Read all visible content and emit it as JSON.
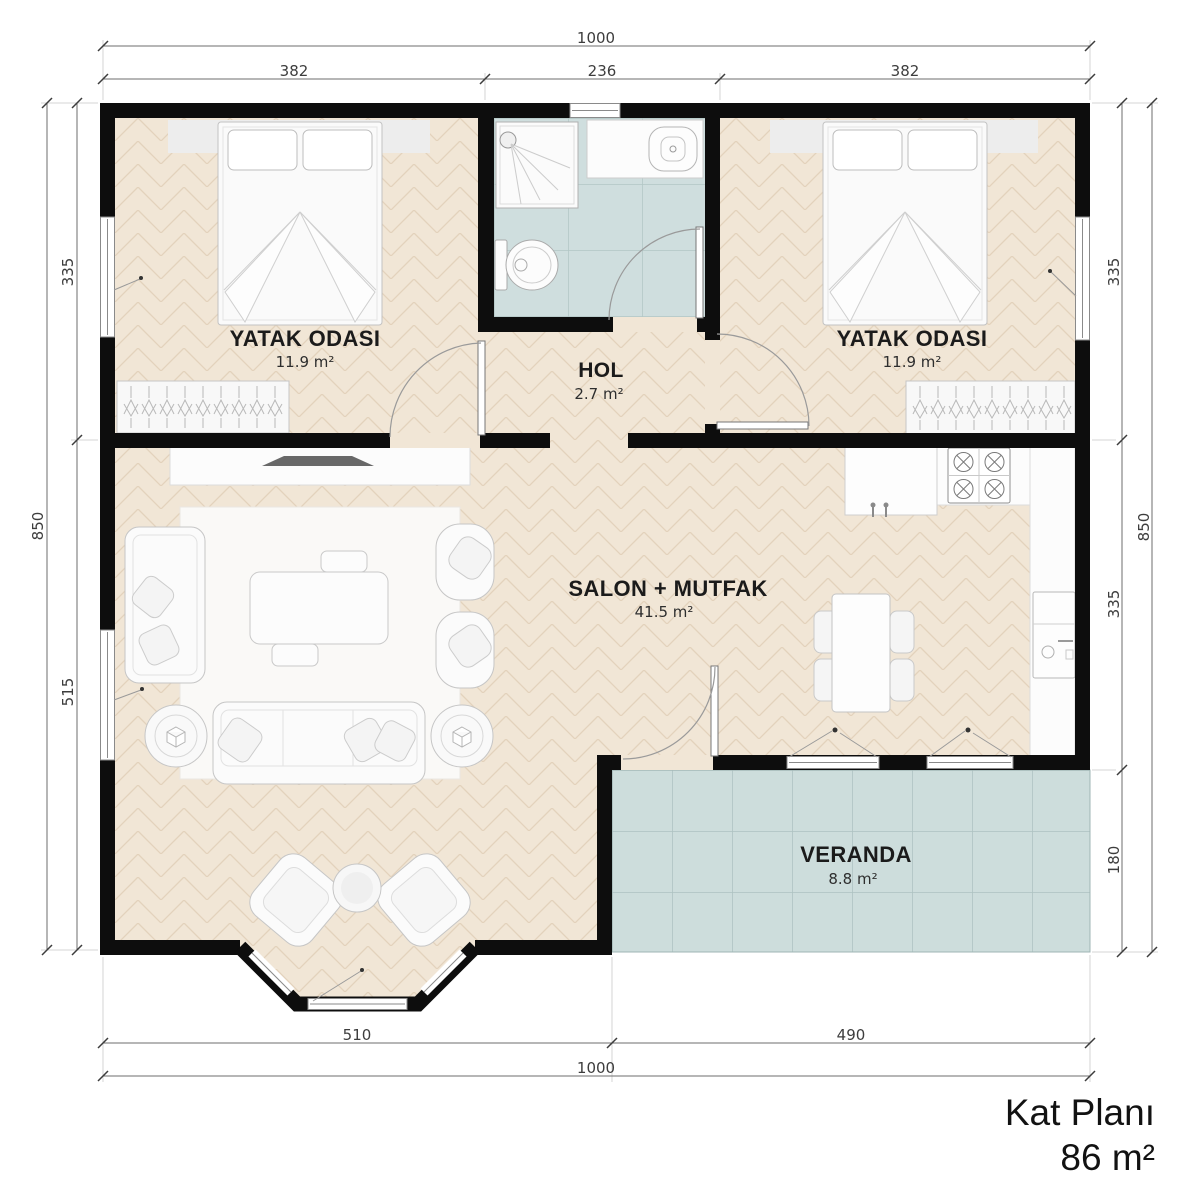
{
  "title": {
    "name": "Kat Planı",
    "area": "86 m²"
  },
  "rooms": {
    "bedroom_left": {
      "name": "YATAK ODASI",
      "area": "11.9 m²"
    },
    "bedroom_right": {
      "name": "YATAK ODASI",
      "area": "11.9 m²"
    },
    "hall": {
      "name": "HOL",
      "area": "2.7 m²"
    },
    "living_kitchen": {
      "name": "SALON + MUTFAK",
      "area": "41.5 m²"
    },
    "veranda": {
      "name": "VERANDA",
      "area": "8.8 m²"
    }
  },
  "dimensions": {
    "top": {
      "overall": "1000",
      "segments": [
        "382",
        "236",
        "382"
      ]
    },
    "bottom": {
      "overall": "1000",
      "segments": [
        "510",
        "490"
      ]
    },
    "left": {
      "overall": "850",
      "segments": [
        "335",
        "515"
      ]
    },
    "right": {
      "overall": "850",
      "segments": [
        "335",
        "335",
        "180"
      ]
    }
  },
  "colors": {
    "wall": "#0d0d0d",
    "parquet": "#f1e6d6",
    "parquet_seam": "#e3d2bc",
    "bath_tile": "#cfdede",
    "veranda_tile": "#cddddc",
    "furniture_fill": "#fbfbfb",
    "furniture_stroke": "#c6c6c6",
    "dim_line": "#6e6e6e"
  }
}
